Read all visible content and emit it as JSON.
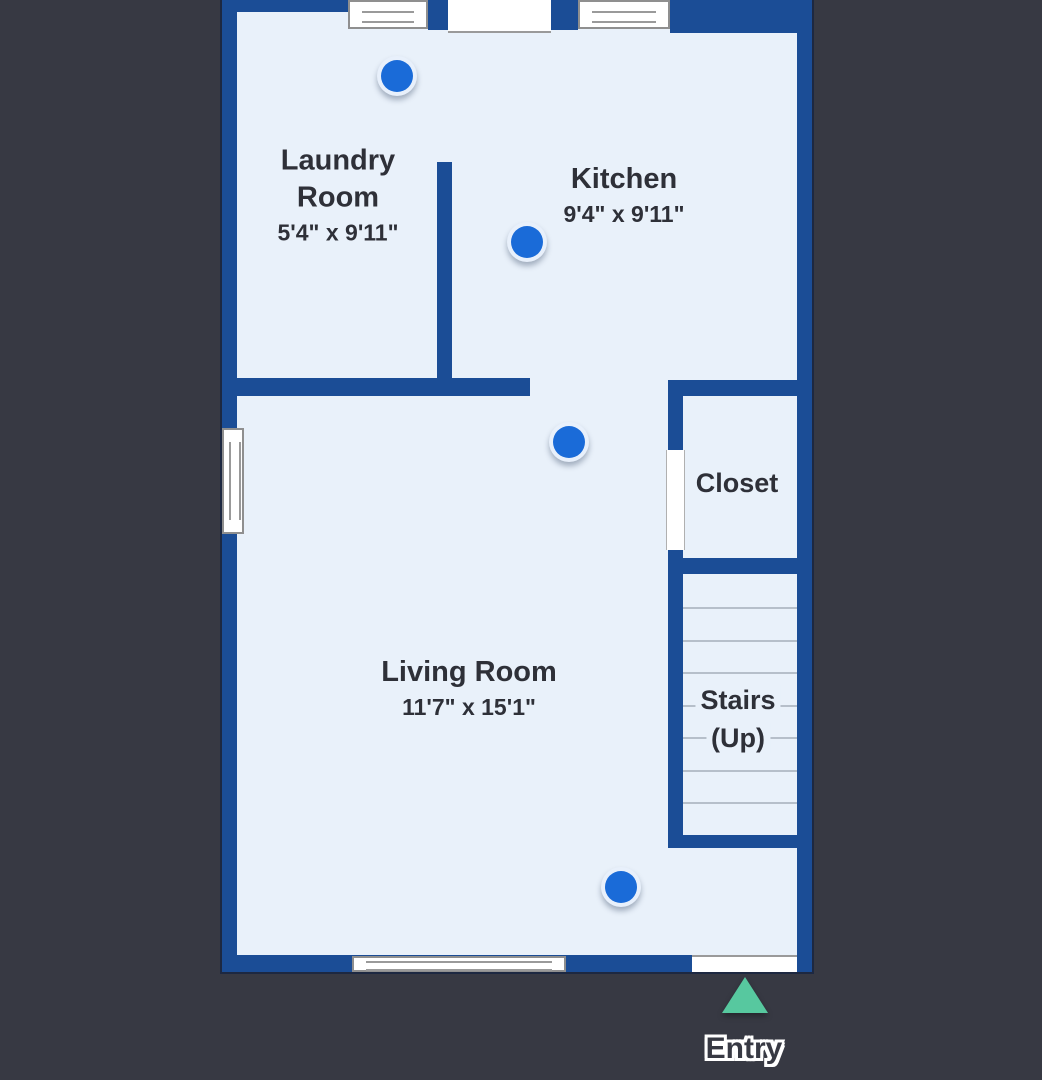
{
  "floorplan": {
    "rooms": {
      "laundry": {
        "line1": "Laundry",
        "line2": "Room",
        "dims": "5'4\" x 9'11\""
      },
      "kitchen": {
        "line1": "Kitchen",
        "dims": "9'4\" x 9'11\""
      },
      "closet": {
        "line1": "Closet"
      },
      "living": {
        "line1": "Living Room",
        "dims": "11'7\" x 15'1\""
      },
      "stairs": {
        "line1": "Stairs",
        "line2": "(Up)"
      }
    },
    "entry": {
      "label": "Entry"
    },
    "camera_dots": [
      {
        "x": 397,
        "y": 76
      },
      {
        "x": 527,
        "y": 242
      },
      {
        "x": 569,
        "y": 442
      },
      {
        "x": 621,
        "y": 887
      }
    ],
    "stair_tread_count": 7,
    "colors": {
      "background": "#373943",
      "wall": "#1b4d96",
      "room_fill": "#e9f1fa",
      "pano_dot": "#1a6bd8",
      "entry_arrow": "#57c89f",
      "label_text": "#2e3038"
    }
  }
}
